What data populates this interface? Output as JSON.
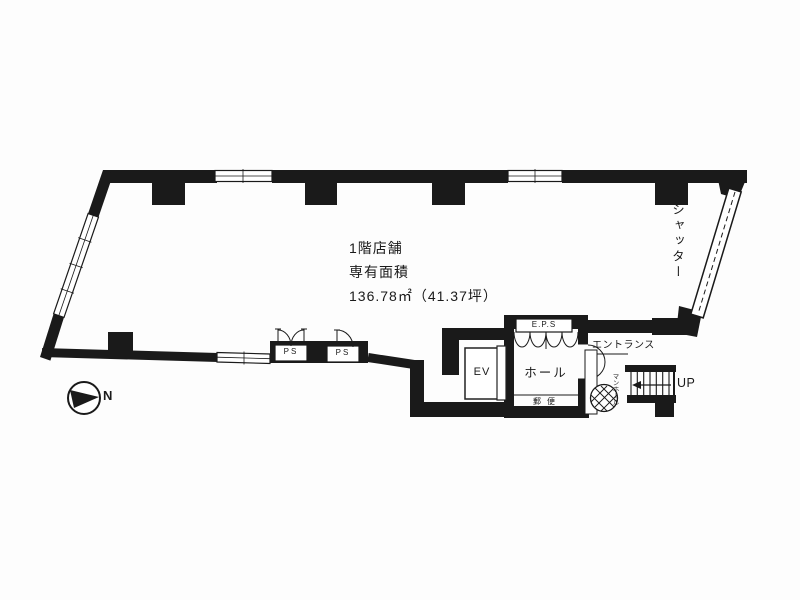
{
  "unit_info": {
    "line1": "1階店舗",
    "line2": "専有面積",
    "line3": "136.78㎡（41.37坪）"
  },
  "labels": {
    "shutter": "シャッター",
    "entrance": "エントランス",
    "hall": "ホール",
    "elevator": "EV",
    "eps": "E.P.S",
    "ps_left": "PS",
    "ps_right": "PS",
    "mail": "郵便",
    "manhole": "マンホール",
    "stairs_up": "UP",
    "north": "N"
  },
  "colors": {
    "ink": "#1a1a1a",
    "paper": "#fdfdfd"
  }
}
